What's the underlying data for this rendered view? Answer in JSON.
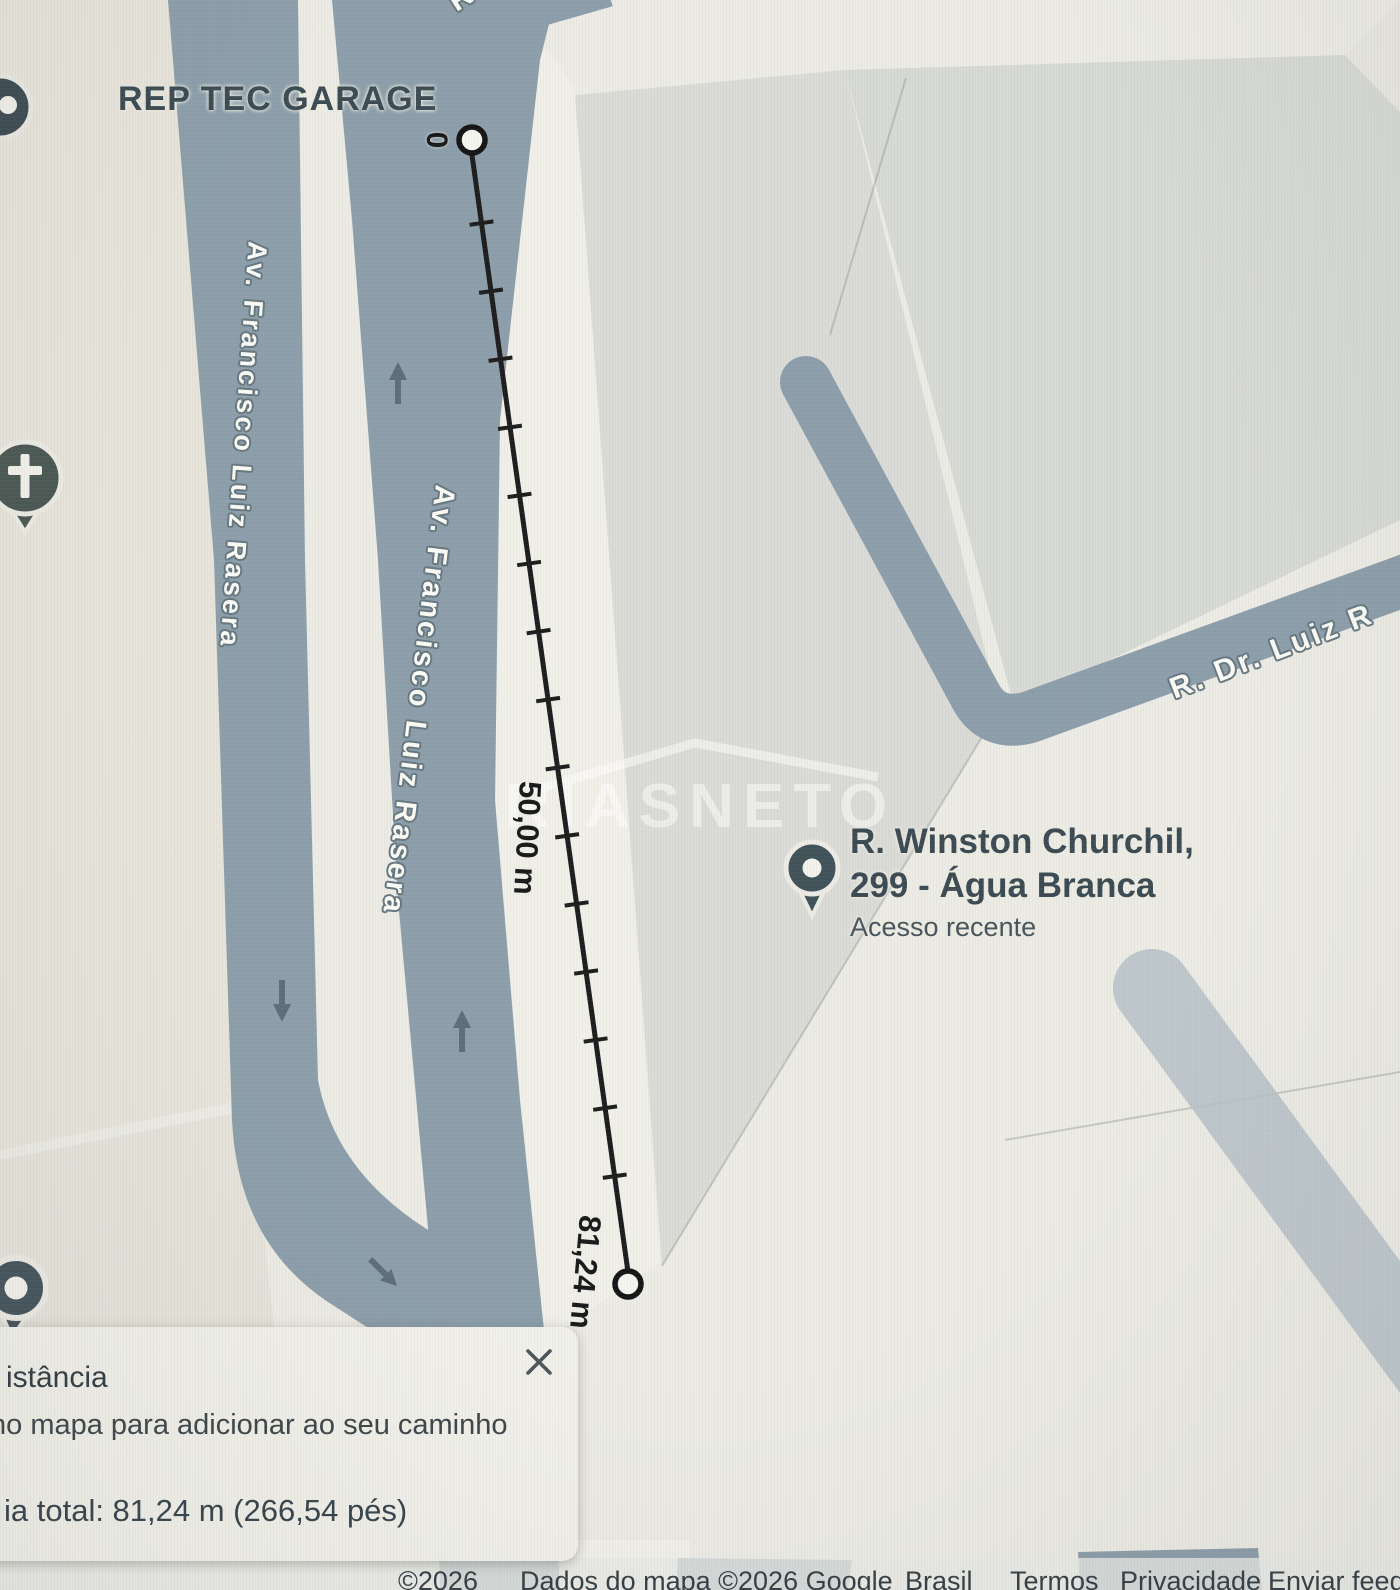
{
  "colors": {
    "road": "#8c9eaa",
    "road_faded": "#b6c1c8",
    "map_base": "#ecebe4",
    "block_beige": "#e7e4da",
    "block_gray": "#dadbd6",
    "marker_dark": "#3f5258",
    "measure_line": "#1c1c1c",
    "poi_text": "#3b4a52"
  },
  "map": {
    "poi_garage": "REP TEC GARAGE",
    "street_left": "Av. Francisco Luiz Rasera",
    "street_middle": "Av. Francisco Luiz Rasera",
    "street_right": "R. Dr. Luiz R",
    "street_top_fragment": "R",
    "watermark": "RIASNETO",
    "recent_place": {
      "name_line1": "R. Winston Churchil,",
      "name_line2": "299 - Água Branca",
      "subtitle": "Acesso recente"
    }
  },
  "measurement": {
    "start_label": "0",
    "mid_label": "50,00 m",
    "end_label": "81,24 m"
  },
  "panel": {
    "title_fragment": "istância",
    "hint_fragment": "no mapa para adicionar ao seu caminho",
    "total_fragment": "ia total: 81,24 m (266,54 pés)"
  },
  "footer": {
    "copyright": "©2026",
    "map_data": "Dados do mapa ©2026 Google",
    "links": [
      "Brasil",
      "Termos",
      "Privacidade",
      "Enviar feedback"
    ]
  }
}
